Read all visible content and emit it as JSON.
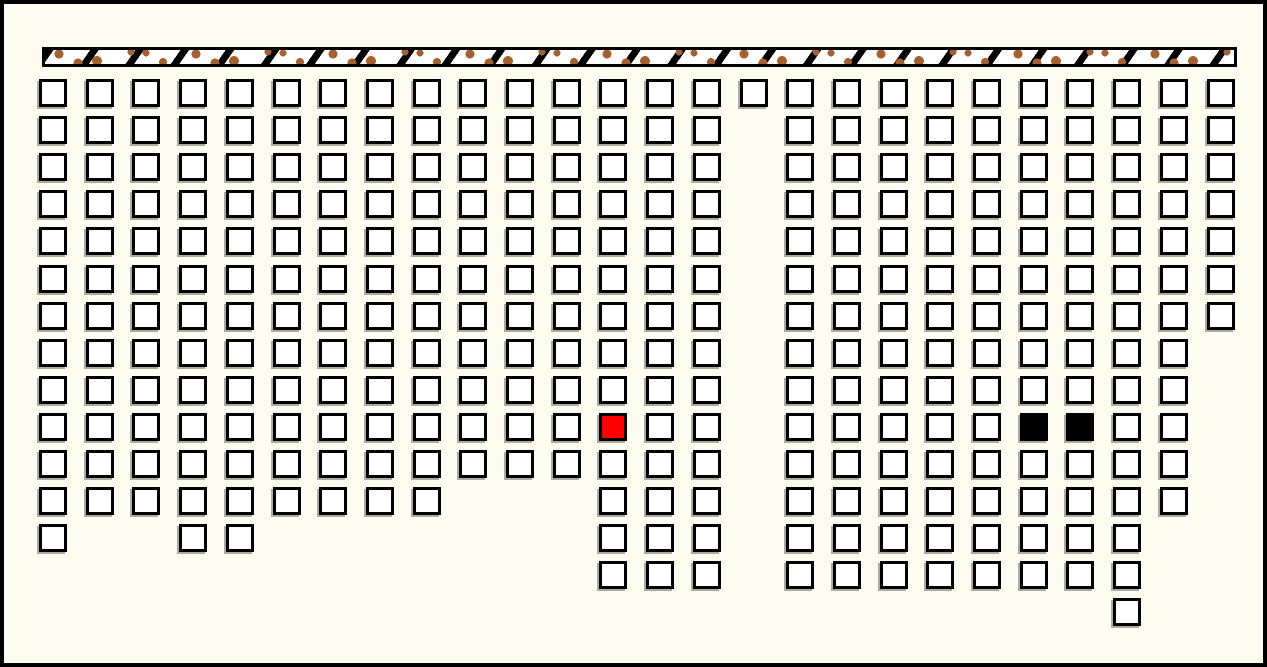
{
  "canvas": {
    "width": 1267,
    "height": 667,
    "background": "#FDFCF0",
    "border_color": "#000000",
    "border_width": 4
  },
  "wall_strip": {
    "x": 38,
    "y": 43,
    "width": 1195,
    "height": 20,
    "fill": "#FFFFFF",
    "dot_color": "#A5602F",
    "dash_color": "#000000",
    "border_color": "#000000"
  },
  "grid": {
    "origin_x": 35,
    "origin_y": 75,
    "pitch_x": 46.7,
    "pitch_y": 37.1,
    "cell_size": 28,
    "cell_border": 3,
    "cell_fill": "#FFFFFF",
    "cell_border_color": "#000000",
    "shadow_color": "#80807A",
    "columns": 26,
    "rows_count": 15
  },
  "highlight_colors": {
    "red": "#FF0000",
    "black": "#000000"
  },
  "rows": [
    {
      "row": 0,
      "cols": [
        0,
        1,
        2,
        3,
        4,
        5,
        6,
        7,
        8,
        9,
        10,
        11,
        12,
        13,
        14,
        15,
        16,
        17,
        18,
        19,
        20,
        21,
        22,
        23,
        24,
        25
      ]
    },
    {
      "row": 1,
      "cols": [
        0,
        1,
        2,
        3,
        4,
        5,
        6,
        7,
        8,
        9,
        10,
        11,
        12,
        13,
        14,
        16,
        17,
        18,
        19,
        20,
        21,
        22,
        23,
        24,
        25
      ]
    },
    {
      "row": 2,
      "cols": [
        0,
        1,
        2,
        3,
        4,
        5,
        6,
        7,
        8,
        9,
        10,
        11,
        12,
        13,
        14,
        16,
        17,
        18,
        19,
        20,
        21,
        22,
        23,
        24,
        25
      ]
    },
    {
      "row": 3,
      "cols": [
        0,
        1,
        2,
        3,
        4,
        5,
        6,
        7,
        8,
        9,
        10,
        11,
        12,
        13,
        14,
        16,
        17,
        18,
        19,
        20,
        21,
        22,
        23,
        24,
        25
      ]
    },
    {
      "row": 4,
      "cols": [
        0,
        1,
        2,
        3,
        4,
        5,
        6,
        7,
        8,
        9,
        10,
        11,
        12,
        13,
        14,
        16,
        17,
        18,
        19,
        20,
        21,
        22,
        23,
        24,
        25
      ]
    },
    {
      "row": 5,
      "cols": [
        0,
        1,
        2,
        3,
        4,
        5,
        6,
        7,
        8,
        9,
        10,
        11,
        12,
        13,
        14,
        16,
        17,
        18,
        19,
        20,
        21,
        22,
        23,
        24,
        25
      ]
    },
    {
      "row": 6,
      "cols": [
        0,
        1,
        2,
        3,
        4,
        5,
        6,
        7,
        8,
        9,
        10,
        11,
        12,
        13,
        14,
        16,
        17,
        18,
        19,
        20,
        21,
        22,
        23,
        24,
        25
      ]
    },
    {
      "row": 7,
      "cols": [
        0,
        1,
        2,
        3,
        4,
        5,
        6,
        7,
        8,
        9,
        10,
        11,
        12,
        13,
        14,
        16,
        17,
        18,
        19,
        20,
        21,
        22,
        23,
        24
      ]
    },
    {
      "row": 8,
      "cols": [
        0,
        1,
        2,
        3,
        4,
        5,
        6,
        7,
        8,
        9,
        10,
        11,
        12,
        13,
        14,
        16,
        17,
        18,
        19,
        20,
        21,
        22,
        23,
        24
      ]
    },
    {
      "row": 9,
      "cols": [
        0,
        1,
        2,
        3,
        4,
        5,
        6,
        7,
        8,
        9,
        10,
        11,
        12,
        13,
        14,
        16,
        17,
        18,
        19,
        20,
        21,
        22,
        23,
        24
      ]
    },
    {
      "row": 10,
      "cols": [
        0,
        1,
        2,
        3,
        4,
        5,
        6,
        7,
        8,
        9,
        10,
        11,
        12,
        13,
        14,
        16,
        17,
        18,
        19,
        20,
        21,
        22,
        23,
        24
      ]
    },
    {
      "row": 11,
      "cols": [
        0,
        1,
        2,
        3,
        4,
        5,
        6,
        7,
        8,
        12,
        13,
        14,
        16,
        17,
        18,
        19,
        20,
        21,
        22,
        23,
        24
      ]
    },
    {
      "row": 12,
      "cols": [
        0,
        3,
        4,
        12,
        13,
        14,
        16,
        17,
        18,
        19,
        20,
        21,
        22,
        23
      ]
    },
    {
      "row": 13,
      "cols": [
        12,
        13,
        14,
        16,
        17,
        18,
        19,
        20,
        21,
        22,
        23
      ]
    },
    {
      "row": 14,
      "cols": [
        23
      ]
    }
  ],
  "special_cells": [
    {
      "col": 12,
      "row": 9,
      "state": "red"
    },
    {
      "col": 21,
      "row": 9,
      "state": "black"
    },
    {
      "col": 22,
      "row": 9,
      "state": "black"
    }
  ]
}
